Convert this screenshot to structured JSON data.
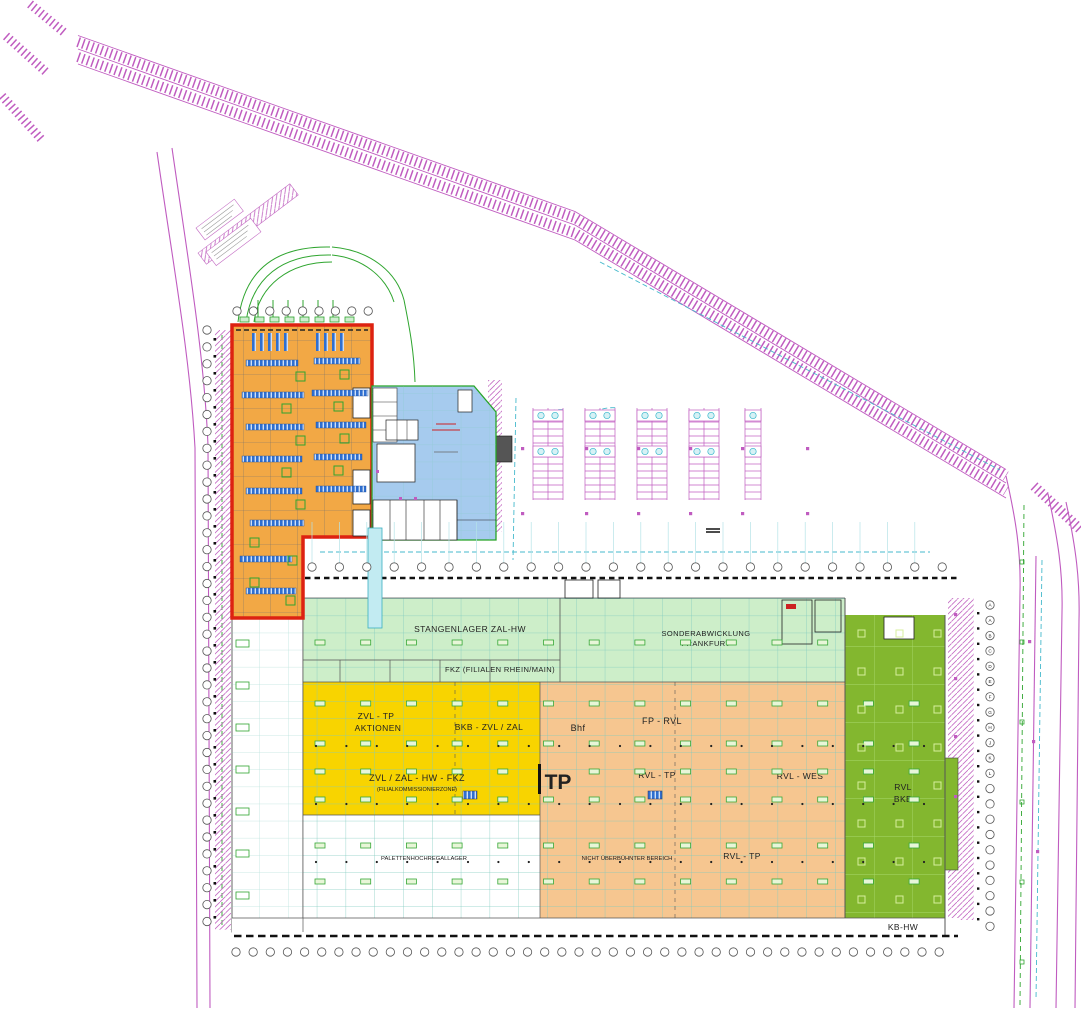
{
  "plan": {
    "labels": {
      "stangenlager": "STANGENLAGER ZAL-HW",
      "fkz": "FKZ (FILIALEN RHEIN/MAIN)",
      "sonder1": "SONDERABWICKLUNG",
      "sonder2": "FRANKFURT",
      "zvl_tp1": "ZVL - TP",
      "zvl_tp2": "AKTIONEN",
      "bkb_zvl_zal": "BKB - ZVL / ZAL",
      "bhf": "Bhf",
      "fp_rvl": "FP - RVL",
      "zvl_zal_hw_fkz": "ZVL / ZAL  -  HW  -  FKZ",
      "filialkommi": "(FILIALKOMMISSIONIERZONE)",
      "tp": "TP",
      "rvl_tp_mid": "RVL - TP",
      "rvl_wes": "RVL - WES",
      "rvl1": "RVL",
      "rvl2": "BKB",
      "paletten": "PALETTENHOCHREGALLAGER",
      "nicht_ueberbuehnt": "NICHT ÜBERBÜHNTER BEREICH",
      "rvl_tp_low": "RVL - TP",
      "kb_hw": "KB-HW"
    },
    "axis_letters_right": [
      "A",
      "A",
      "B",
      "C",
      "D",
      "E",
      "F",
      "G",
      "H",
      "J",
      "K",
      "L"
    ],
    "colors": {
      "hall_light_green": "#cdeec9",
      "zone_yellow": "#f8d400",
      "zone_tan": "#f6c690",
      "zone_green": "#83b72f",
      "building_orange": "#f2a845",
      "building_blue": "#a6cbee",
      "outline_red": "#dd2211",
      "road_magenta": "#c05cc0",
      "grid_teal": "#7fcabe",
      "detail_green": "#2fa52f",
      "rack_blue": "#2f6fd0",
      "arrow_cyan": "#45b9cc"
    }
  }
}
